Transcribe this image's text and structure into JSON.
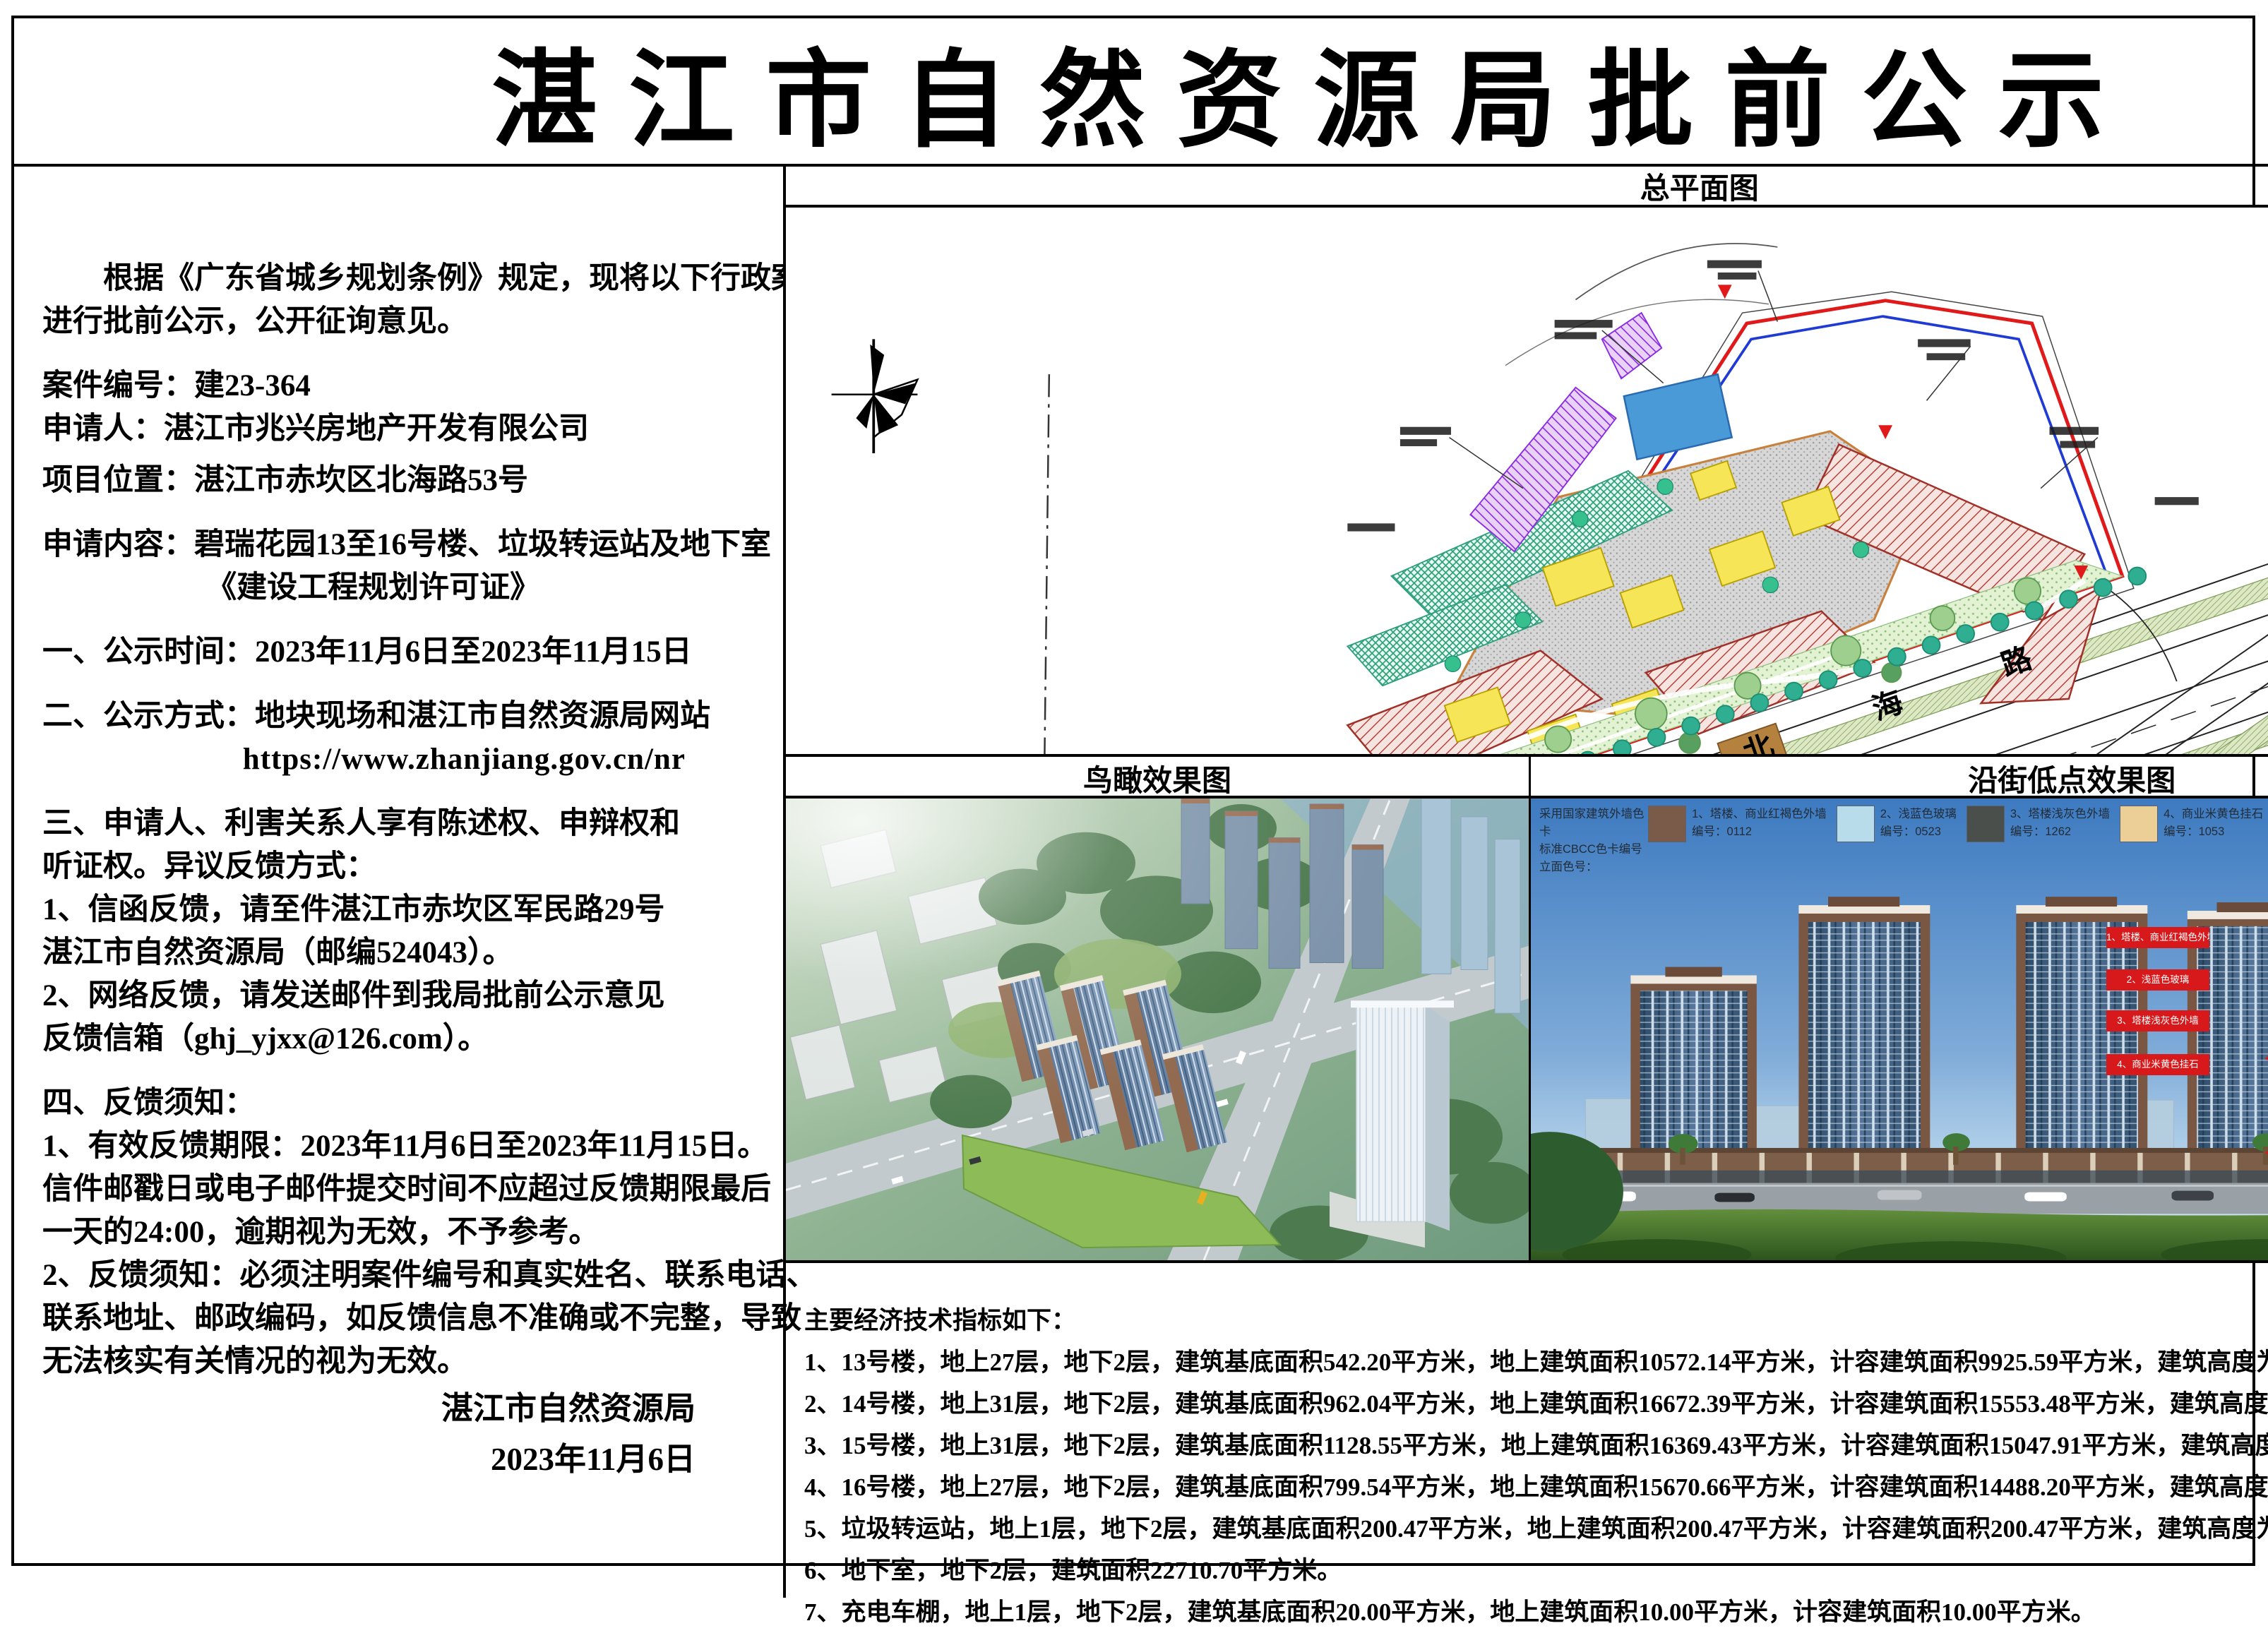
{
  "title": "湛江市自然资源局批前公示",
  "left": {
    "lines": [
      "根据《广东省城乡规划条例》规定，现将以下行政案件",
      "进行批前公示，公开征询意见。",
      "案件编号：建23-364",
      "申请人：湛江市兆兴房地产开发有限公司",
      "项目位置：湛江市赤坎区北海路53号",
      "申请内容：碧瑞花园13至16号楼、垃圾转运站及地下室",
      "《建设工程规划许可证》",
      "一、公示时间：2023年11月6日至2023年11月15日",
      "二、公示方式：地块现场和湛江市自然资源局网站",
      "https://www.zhanjiang.gov.cn/nr",
      "三、申请人、利害关系人享有陈述权、申辩权和",
      "听证权。异议反馈方式：",
      "1、信函反馈，请至件湛江市赤坎区军民路29号",
      "湛江市自然资源局（邮编524043）。",
      "2、网络反馈，请发送邮件到我局批前公示意见",
      "反馈信箱（ghj_yjxx@126.com）。",
      "四、反馈须知：",
      "1、有效反馈期限：2023年11月6日至2023年11月15日。",
      "信件邮戳日或电子邮件提交时间不应超过反馈期限最后",
      "一天的24:00，逾期视为无效，不予参考。",
      "2、反馈须知：必须注明案件编号和真实姓名、联系电话、",
      "联系地址、邮政编码，如反馈信息不准确或不完整，导致",
      "无法核实有关情况的视为无效。"
    ],
    "signature": {
      "org": "湛江市自然资源局",
      "date": "2023年11月6日"
    }
  },
  "panels": {
    "site_plan": {
      "title": "总平面图",
      "road_chars": [
        "北",
        "海",
        "路"
      ]
    },
    "birdseye": {
      "title": "鸟瞰效果图"
    },
    "street": {
      "title": "沿街低点效果图",
      "legend": {
        "intro_lines": [
          "采用国家建筑外墙色卡",
          "标准CBCC色卡编号",
          "立面色号："
        ],
        "items": [
          {
            "label": "1、塔楼、商业红褐色外墙",
            "code": "编号：0112",
            "color": "#7a5b4a"
          },
          {
            "label": "2、浅蓝色玻璃",
            "code": "编号：0523",
            "color": "#b8dcea"
          },
          {
            "label": "3、塔楼浅灰色外墙",
            "code": "编号：1262",
            "color": "#4a4f4c"
          },
          {
            "label": "4、商业米黄色挂石",
            "code": "编号：1053",
            "color": "#eccf97"
          }
        ]
      },
      "callouts": [
        "1、塔楼、商业红褐色外墙",
        "2、浅蓝色玻璃",
        "3、塔楼浅灰色外墙",
        "4、商业米黄色挂石"
      ],
      "callout_color": "#d7191c"
    }
  },
  "indicators": {
    "heading": "主要经济技术指标如下：",
    "lines": [
      "1、13号楼，地上27层，地下2层，建筑基底面积542.20平方米，地上建筑面积10572.14平方米，计容建筑面积9925.59平方米，建筑高度为84.15米(室外地面至屋面)。",
      "2、14号楼，地上31层，地下2层，建筑基底面积962.04平方米，地上建筑面积16672.39平方米，计容建筑面积15553.48平方米，建筑高度为96.15米(室外地面至屋面)。",
      "3、15号楼，地上31层，地下2层，建筑基底面积1128.55平方米，地上建筑面积16369.43平方米，计容建筑面积15047.91平方米，建筑高度为96.15米(室外地面至屋面)。",
      "4、16号楼，地上27层，地下2层，建筑基底面积799.54平方米，地上建筑面积15670.66平方米，计容建筑面积14488.20平方米，建筑高度为84.15米(室外地面至屋面)。",
      "5、垃圾转运站，地上1层，地下2层，建筑基底面积200.47平方米，地上建筑面积200.47平方米，计容建筑面积200.47平方米，建筑高度为6.20米(室外地面至屋面)。",
      "6、地下室，地下2层，建筑面积22710.70平方米。",
      "7、充电车棚，地上1层，地下2层，建筑基底面积20.00平方米，地上建筑面积10.00平方米，计容建筑面积10.00平方米。"
    ]
  }
}
